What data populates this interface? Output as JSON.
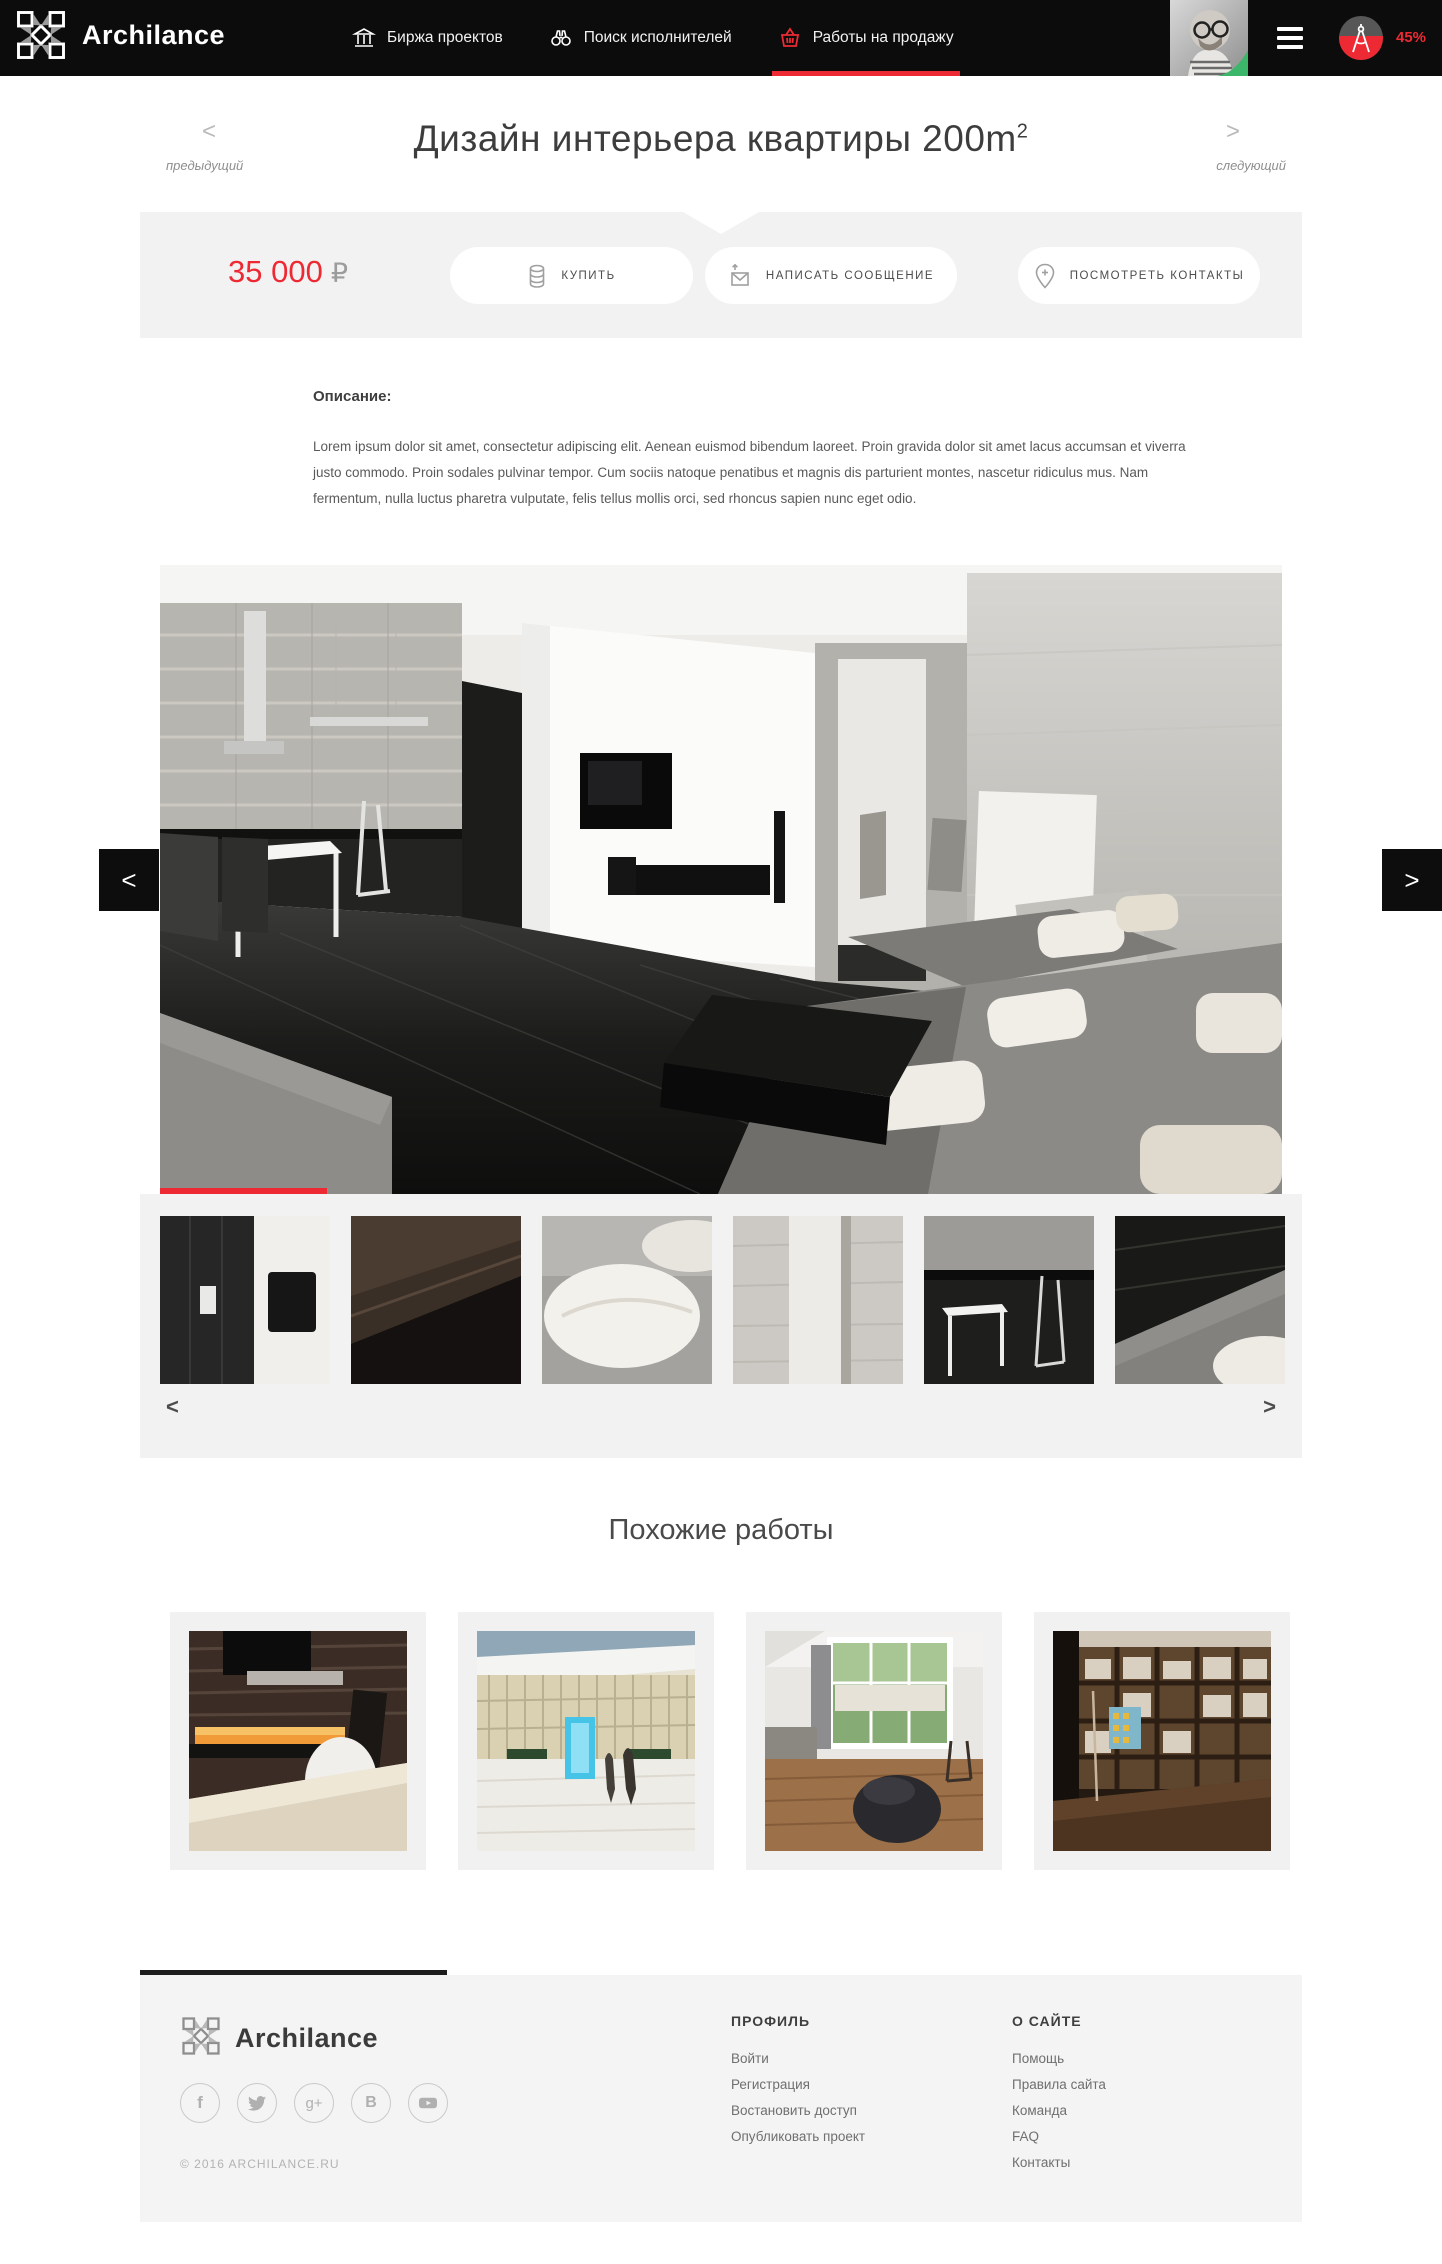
{
  "brand": {
    "name": "Archilance"
  },
  "navbar": {
    "items": [
      {
        "label": "Биржа проектов",
        "icon": "column-icon",
        "active": false
      },
      {
        "label": "Поиск исполнителей",
        "icon": "binoculars-icon",
        "active": false
      },
      {
        "label": "Работы на продажу",
        "icon": "basket-icon",
        "active": true
      }
    ],
    "progress_label": "45%"
  },
  "page_header": {
    "title": "Дизайн интерьера квартиры 200m",
    "title_sup": "2",
    "prev_arrow": "<",
    "next_arrow": ">",
    "prev_label": "предыдущий",
    "next_label": "следующий"
  },
  "purchase": {
    "price": "35 000",
    "currency": "₽",
    "buy_label": "КУПИТЬ",
    "message_label": "НАПИСАТЬ СООБЩЕНИЕ",
    "contacts_label": "ПОСМОТРЕТЬ КОНТАКТЫ"
  },
  "description": {
    "heading": "Описание:",
    "text": "Lorem ipsum dolor sit amet, consectetur adipiscing elit. Aenean euismod bibendum laoreet. Proin gravida dolor sit amet lacus accumsan et viverra justo commodo. Proin sodales pulvinar tempor. Cum sociis natoque penatibus et magnis dis parturient montes, nascetur ridiculus mus. Nam fermentum, nulla luctus pharetra vulputate, felis tellus mollis orci, sed rhoncus sapien nunc eget odio."
  },
  "gallery": {
    "prev_arrow": "<",
    "next_arrow": ">",
    "thumb_prev_arrow": "<",
    "thumb_next_arrow": ">"
  },
  "similar": {
    "heading": "Похожие работы"
  },
  "footer": {
    "brand": "Archilance",
    "copyright": "© 2016 ARCHILANCE.RU",
    "columns": [
      {
        "heading": "ПРОФИЛЬ",
        "links": [
          "Войти",
          "Регистрация",
          "Востановить доступ",
          "Опубликовать проект"
        ]
      },
      {
        "heading": "О САЙТЕ",
        "links": [
          "Помощь",
          "Правила сайта",
          "Команда",
          "FAQ",
          "Контакты"
        ]
      }
    ],
    "social": [
      "facebook",
      "twitter",
      "google-plus",
      "vk",
      "youtube"
    ]
  },
  "colors": {
    "accent": "#ed2a33",
    "navbar_bg": "#0c0c0c",
    "band_bg": "#f2f2f2",
    "footer_bg": "#f4f4f4",
    "avatar_accent_green": "#3cb76a"
  }
}
